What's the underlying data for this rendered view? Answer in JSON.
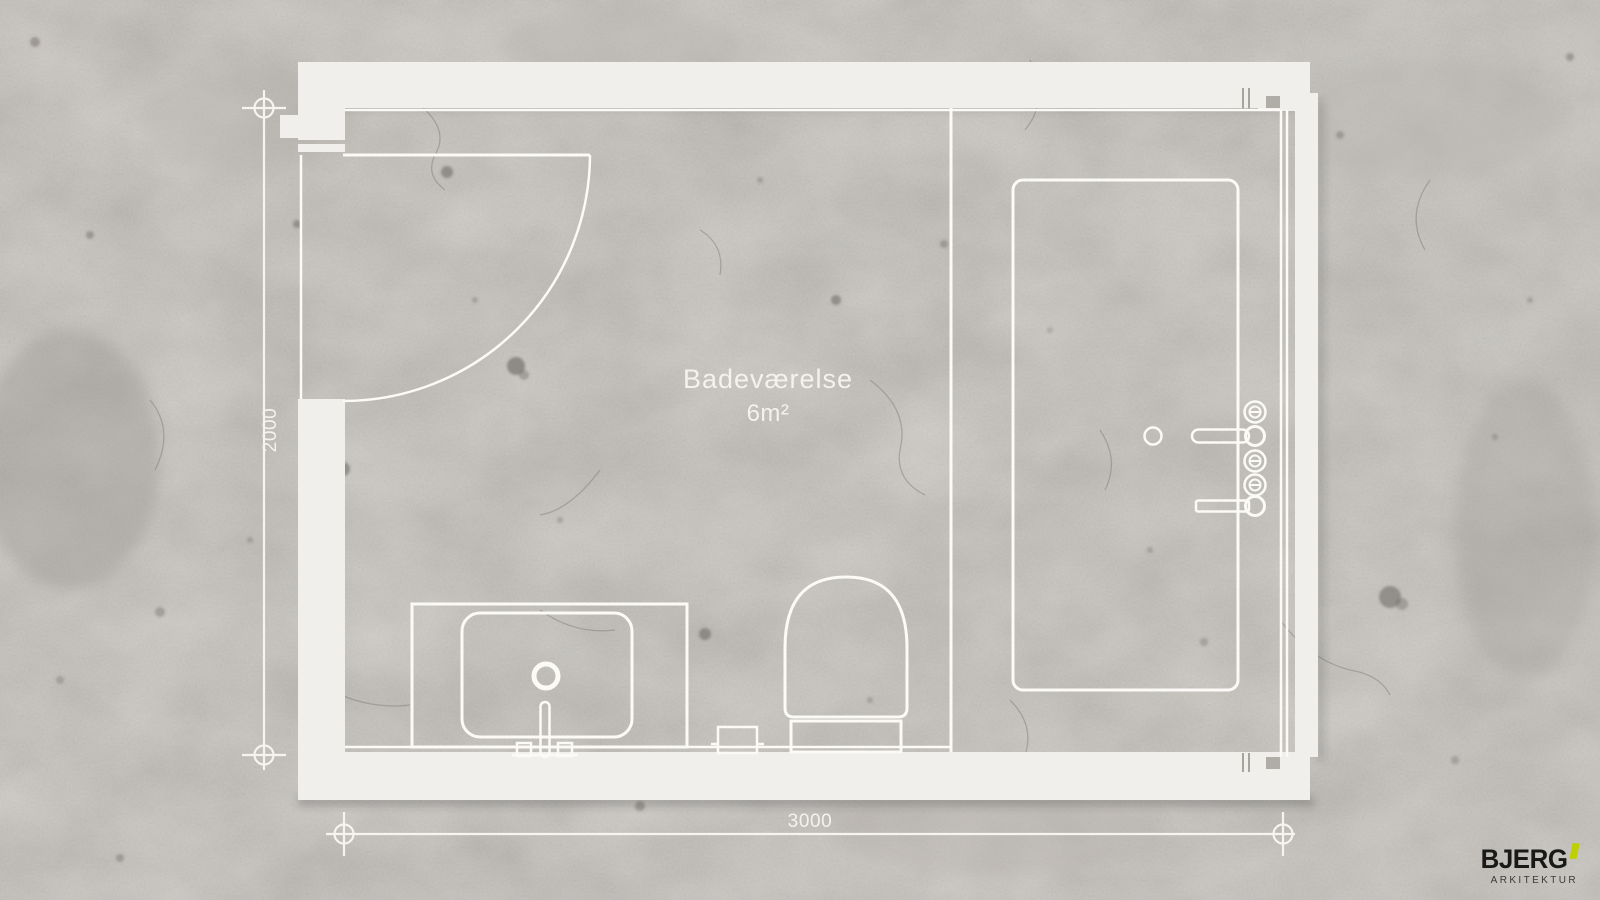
{
  "floor_plan": {
    "room": {
      "label": "Badeværelse",
      "area": "6m²"
    },
    "dimensions": {
      "width_mm": "3000",
      "height_mm": "2000"
    },
    "fixtures": [
      "entry-door",
      "vanity-with-sink",
      "faucet",
      "toilet",
      "floor-drain",
      "shower-tray",
      "shower-drain",
      "shower-valves",
      "shower-arm",
      "shower-handle",
      "glass-partition"
    ]
  },
  "branding": {
    "wordmark": "BJERG",
    "subtitle": "ARKITEKTUR",
    "accent_color": "#bdd002"
  },
  "palette": {
    "concrete": "#a8a49e",
    "wall_fill": "#f1efec",
    "line_white": "#fbfaf7",
    "logo_black": "#191917"
  }
}
